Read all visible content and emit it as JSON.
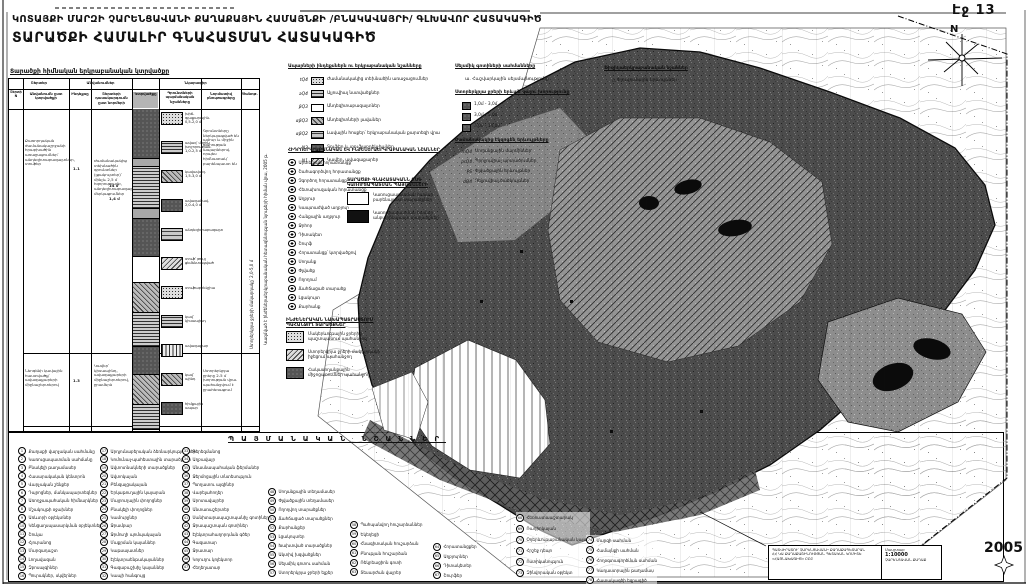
{
  "page": {
    "number_label": "Էջ 13",
    "year": "2005",
    "north_label": "N"
  },
  "titles": {
    "line1": "ԿՈՏԱՅՔԻ ՄԱՐԶԻ ՉԱՐԵՆՑԱՎԱՆԻ ՔԱՂԱՔԱՅԻՆ ՀԱՄԱՅՆՔԻ /ԲՆԱԿԱՎԱՅՐԻ/ ԳԼԽԱՎՈՐ ՀԱՏԱԿԱԳԻԾ",
    "line2": "ՏԱՐԱԾՔԻ ՀԱՄԱԼԻՐ ԳՆԱՀԱՏՄԱՆ ՀԱՏԱԿԱԳԻԾ"
  },
  "side_note": "Կազմված է ինժեներաերկրաբանական հետազննության նյութերի հիման վրա, 2005 թ.",
  "table": {
    "caption": "Տարածքի հիմնական երկրաբանական կտրվածքը",
    "groups": [
      "Շերտեր",
      "Անվանումներ",
      "Նկարագիր"
    ],
    "cols": [
      "Շերտի N",
      "Անվանումն ըստ կտրվածքի",
      "Ինդեքսը",
      "Շերտերի դասակարգումն ըստ նորմերի",
      "Կտրվածքը",
      "Գրունտների պայմանական նշանները",
      "Նորմատիվ բնութագրերը",
      "Ծանոթ."
    ],
    "idx1": "1.1",
    "idx2": "1.3",
    "thick1": "14 մ",
    "thick2": "1,4 մ",
    "row1_name": "Քառորդական ժամանակաշրջանի հրաբխածին առաջացումներ՝ անդեզիտաբազալտներ, տուֆեր",
    "row1_desc": "Ժամանակակից տեխնածին գրունտներ (լցակույտեր)՝ մինչև 2,5 մ հզորությամբ, անդեզիտաբազալտների մերկացումներ",
    "row1_note": "Գրունտները ներկայացված են ամուր և միջին ամրության ապարներով. որպես հիմնատակ՝ բարենպաստ են",
    "row2_name": "Նեոգենի կավային հաստվածք՝ ավազաքարերի միջնաշերտերով",
    "row2_desc": "Կավեր՝ կիսապինդ, ավազաքարերի միջնաշերտերով, ջրամերձ",
    "row2_note": "Ստորերկրյա ջրերը 2-5 մ խորության վրա. պահանջվում է ջրահեռացում",
    "note_rot": "Ստորերկրյա ջրերի մակարդակը՝ 2,0-5,0 մ",
    "strat": [
      {
        "cls": "sw-darknoise",
        "style": "height:50px"
      },
      {
        "cls": "sw-gray",
        "style": "height:8px"
      },
      {
        "cls": "sw-dash",
        "style": "height:42px"
      },
      {
        "cls": "sw-gray",
        "style": "height:10px"
      },
      {
        "cls": "sw-darknoise",
        "style": "height:38px"
      },
      {
        "cls": "sw-white",
        "style": "height:26px"
      },
      {
        "cls": "sw-diag",
        "style": "height:30px"
      },
      {
        "cls": "sw-dash",
        "style": "height:34px"
      },
      {
        "cls": "sw-darknoise",
        "style": "height:28px"
      },
      {
        "cls": "sw-diag",
        "style": "height:30px"
      },
      {
        "cls": "sw-dash",
        "style": "height:25px"
      }
    ],
    "thumbs": [
      {
        "cls": "sw-dots",
        "cap": "խիճ-գլաքարային. 0,5-2,0 մ"
      },
      {
        "cls": "sw-dash",
        "cap": "ավազ՝ միջին խոշորության. 1,0-2,5 մ"
      },
      {
        "cls": "sw-diag",
        "cap": "կավավազ. 1,5-3,0 մ"
      },
      {
        "cls": "sw-darknoise",
        "cap": "ավազակավ. 2,0-4,0 մ"
      },
      {
        "cls": "sw-brick",
        "cap": "անդեզիտաբազալտ"
      },
      {
        "cls": "sw-diag2",
        "cap": "տուֆ՝ թույլ ցեմենտացված"
      },
      {
        "cls": "sw-dots",
        "cap": "տուֆաբրեկչիա"
      },
      {
        "cls": "sw-dash",
        "cap": "կավ՝ կիսապինդ"
      },
      {
        "cls": "sw-vlines",
        "cap": "ավազաքար"
      },
      {
        "cls": "sw-diag",
        "cap": "կավ՝ պինդ"
      },
      {
        "cls": "sw-darknoise",
        "cap": "հիմքային ապար"
      }
    ]
  },
  "geo": {
    "h": "Ապարների ինդեքսներն ու երկրաբանական նշանները",
    "items": [
      {
        "ix": "tQ4",
        "cls": "sw-dots",
        "label": "Ժամանակակից տեխնածին առաջացումներ"
      },
      {
        "ix": "aQ4",
        "cls": "sw-dash",
        "label": "Ալյուվիալ նստվածքներ"
      },
      {
        "ix": "βQ3",
        "cls": "sw-white",
        "label": "Անդեզիտաբազալտներ"
      },
      {
        "ix": "αβQ3",
        "cls": "sw-diag",
        "label": "Անդեզիտների լավաներ"
      },
      {
        "ix": "αβQ2",
        "cls": "sw-brick",
        "label": "Լավային հոսքեր՝ երկրաբանական քարտեզի վրա"
      },
      {
        "ix": "N2",
        "cls": "sw-darknoise",
        "label": "Տուֆեր և տուֆաբրեկչիաներ"
      },
      {
        "ix": "N1",
        "cls": "sw-diag2",
        "label": "Կավեր, ավազաքարեր"
      }
    ]
  },
  "seismic": {
    "h": "Սեյսմիկ գոտիների սահմանները",
    "item": "ա.  Հաշվարկային սեյսմայնությունը"
  },
  "gw": {
    "h": "Ստորերկրյա ջրերի երևան գալու խորությունը",
    "items": [
      {
        "cls": "sw-darknoise",
        "label": "1,0մ - 3,0մ"
      },
      {
        "cls": "sw-darknoise",
        "label": "3,0մ - 5,0մ"
      },
      {
        "cls": "sw-darknoise",
        "label": "5,0մ - 10,0մ"
      }
    ]
  },
  "exo": {
    "h": "Ժամանակակից էկզոգեն երևույթները",
    "items": [
      {
        "ix": "mQ4",
        "label": "Սողանքային մարմիններ"
      },
      {
        "ix": "prQ4",
        "label": "Պրոլյուվիալ արտածումներ"
      },
      {
        "ix": "PS",
        "label": "Փլվածքային երևույթներ"
      },
      {
        "ix": "dQ4",
        "label": "Դելյուվիալ ծածկույթներ"
      }
    ]
  },
  "phys": {
    "h": "Ֆիզիկաերկրաբանական նշաններ",
    "icon": "△",
    "item": "Փլուզումային երևույթներ"
  },
  "hydro": {
    "h": "ՀԻԴՐՈԵՐԿՐԱԲԱՆԱԿԱՆ ԵՎ ԻՆԺԵՆԵՐԱԵՐԿՐԱԲԱՆԱԿԱՆ ՆՇԱՆՆԵՐ",
    "items": [
      "Արտեզյան հորատանցք",
      "Շահագործվող հորատանցք",
      "Չգործող հորատանցք",
      "Հետախուզական հորատանցք",
      "Աղբյուր",
      "Կապտաժված աղբյուր",
      "Հանքային աղբյուր",
      "Ջրհոր",
      "Դիտակետ",
      "Շուրֆ",
      "Հորատանցք՝ կտրվածքով",
      "Սողանք",
      "Փլվածք",
      "Ողողում",
      "Ճահճացած տարածք",
      "Լցակույտ",
      "Քարհանք"
    ]
  },
  "assess": {
    "h1": "ՏԱՐԱԾՔԻ ԳՆԱՀԱՏԱԿԱՆՆ ԸՍՏ",
    "h2": "ԿԱՌՈՒՑԱՊԱՏՄԱՆ ՊԱՅՄԱՆՆԵՐԻ",
    "items": [
      {
        "cls": "sw-white",
        "l1": "Կառուցապատման համար",
        "l2": "բարենպաստ տարածքներ"
      },
      {
        "cls": "sw-black",
        "l1": "Կառուցապատման համար",
        "l2": "անբարենպաստ տարածքներ"
      }
    ]
  },
  "eng": {
    "h1": "ԻՆԺԵՆԵՐԱԿԱՆ ՆԱԽԱՊԱՏՐԱՍՏՈՒՄ",
    "h2": "ՊԱՀԱՆՋՈՂ ՏԱՐԱԾՔՆԵՐ",
    "items": [
      {
        "cls": "sw-dots",
        "l1": "Մակերևութային ջրերից",
        "l2": "պաշտպանում պահանջող"
      },
      {
        "cls": "sw-diag2",
        "l1": "Ստորերկրյա ջրերի մակարդակի",
        "l2": "իջեցում պահանջող"
      },
      {
        "cls": "sw-darknoise",
        "l1": "Հակասողանքային",
        "l2": "միջոցառումներ պահանջող"
      }
    ]
  },
  "cond": {
    "letters": "ՊԱՅՄԱՆԱԿԱՆ ՆՇԱՆՆԵՐ",
    "cols": [
      {
        "items": [
          {
            "n": "1",
            "label": "Քաղաքի վարչական սահմանը"
          },
          {
            "n": "2",
            "label": "Կառուցապատման սահմանը"
          },
          {
            "n": "3",
            "label": "Բնակելի թաղամասեր"
          },
          {
            "n": "4",
            "label": "Հասարակական կենտրոն"
          },
          {
            "n": "5",
            "label": "Վարչական շենքեր"
          },
          {
            "n": "6",
            "label": "Դպրոցներ, մանկապարտեզներ"
          },
          {
            "n": "7",
            "label": "Առողջապահական հիմնարկներ"
          },
          {
            "n": "8",
            "label": "Մշակույթի օջախներ"
          },
          {
            "n": "9",
            "label": "Առևտրի օբյեկտներ"
          },
          {
            "n": "10",
            "label": "Կենցաղսպասարկման օբյեկտներ"
          },
          {
            "n": "11",
            "label": "Շուկա"
          },
          {
            "n": "12",
            "label": "Հյուրանոց"
          },
          {
            "n": "13",
            "label": "Մարզադաշտ"
          },
          {
            "n": "14",
            "label": "Լողավազան"
          },
          {
            "n": "15",
            "label": "Զբոսայգիներ"
          },
          {
            "n": "16",
            "label": "Պուրակներ, սկվերներ"
          }
        ]
      },
      {
        "items": [
          {
            "n": "17",
            "label": "Արդյունաբերական ձեռնարկություններ"
          },
          {
            "n": "18",
            "label": "Կոմունալ-պահեստային տարածքներ"
          },
          {
            "n": "19",
            "label": "Ավտոտնակների տարածքներ"
          },
          {
            "n": "20",
            "label": "Ավտոկայան"
          },
          {
            "n": "21",
            "label": "Բենզալցակայան"
          },
          {
            "n": "22",
            "label": "Երկաթուղային կայարան"
          },
          {
            "n": "23",
            "label": "Մայրուղային փողոցներ"
          },
          {
            "n": "24",
            "label": "Բնակելի փողոցներ"
          },
          {
            "n": "25",
            "label": "Կամուրջներ"
          },
          {
            "n": "26",
            "label": "Ջրամբար"
          },
          {
            "n": "27",
            "label": "Ջրմուղի պոմպակայան"
          },
          {
            "n": "28",
            "label": "Մաքրման կայաններ"
          },
          {
            "n": "29",
            "label": "Կաթսայատներ"
          },
          {
            "n": "30",
            "label": "Էլեկտրաենթակայաններ"
          },
          {
            "n": "31",
            "label": "Գազաբաշխիչ կայաններ"
          },
          {
            "n": "32",
            "label": "Կապի հանգույց"
          }
        ]
      },
      {
        "items": [
          {
            "n": "33",
            "label": "Գերեզմանոց"
          },
          {
            "n": "34",
            "label": "Աղբավայր"
          },
          {
            "n": "35",
            "label": "Անասնապահական ֆերմաներ"
          },
          {
            "n": "36",
            "label": "Ջերմոցային տնտեսություն"
          },
          {
            "n": "37",
            "label": "Պտղատու այգիներ"
          },
          {
            "n": "38",
            "label": "Վարելահողեր"
          },
          {
            "n": "39",
            "label": "Արոտավայրեր"
          },
          {
            "n": "40",
            "label": "Անտառաշերտեր"
          },
          {
            "n": "41",
            "label": "Սանիտարապաշտպանիչ գոտիներ"
          },
          {
            "n": "42",
            "label": "Ջրապաշտպան գոտիներ"
          },
          {
            "n": "43",
            "label": "Էլեկտրահաղորդման գծեր"
          },
          {
            "n": "44",
            "label": "Գազատար"
          },
          {
            "n": "45",
            "label": "Ջրատար"
          },
          {
            "n": "46",
            "label": "Կոյուղու կոլեկտոր"
          },
          {
            "n": "47",
            "label": "Հեղեղատար"
          }
        ]
      },
      {
        "items": [
          {
            "n": "48",
            "label": "Սողանքային տեղամասեր"
          },
          {
            "n": "49",
            "label": "Փլվածքային տեղամասեր"
          },
          {
            "n": "50",
            "label": "Ողողվող տարածքներ"
          },
          {
            "n": "51",
            "label": "Ճահճացած տարածքներ"
          },
          {
            "n": "52",
            "label": "Քարհանքեր"
          },
          {
            "n": "53",
            "label": "Լցակույտեր"
          },
          {
            "n": "54",
            "label": "Խախտված տարածքներ"
          },
          {
            "n": "55",
            "label": "Ակտիվ խզվածքներ"
          },
          {
            "n": "56",
            "label": "Սեյսմիկ գոտու սահման"
          },
          {
            "n": "57",
            "label": "Ստորերկրյա ջրերի ելքեր"
          }
        ]
      },
      {
        "items": [
          {
            "n": "58",
            "label": "Պահպանվող հուշարձաններ"
          },
          {
            "n": "59",
            "label": "Եկեղեցի"
          },
          {
            "n": "60",
            "label": "Հնագիտական հուշարձան"
          },
          {
            "n": "61",
            "label": "Բնության հուշարձան"
          },
          {
            "n": "62",
            "label": "Ռեկրեացիոն գոտի"
          },
          {
            "n": "63",
            "label": "Տեսարժան վայրեր"
          }
        ]
      },
      {
        "items": [
          {
            "n": "64",
            "label": "Հորատանցքեր"
          },
          {
            "n": "65",
            "label": "Աղբյուրներ"
          },
          {
            "n": "66",
            "label": "Դիտակետեր"
          },
          {
            "n": "67",
            "label": "Շուրֆեր"
          }
        ]
      },
      {
        "items": [
          {
            "n": "68",
            "label": "Հեռուստաաշտարակ"
          },
          {
            "n": "69",
            "label": "Ռադիոկայան"
          },
          {
            "n": "70",
            "label": "Օդերևութաբանական կայան"
          },
          {
            "n": "71",
            "label": "Հրշեջ դեպո"
          },
          {
            "n": "72",
            "label": "Ոստիկանություն"
          },
          {
            "n": "73",
            "label": "Զինվորական օբյեկտ"
          }
        ]
      },
      {
        "items": [
          {
            "n": "74",
            "label": "Մարզի սահման"
          },
          {
            "n": "75",
            "label": "Համայնքի սահման"
          },
          {
            "n": "76",
            "label": "Հողօգտագործման սահման"
          },
          {
            "n": "77",
            "label": "Կադաստրային թաղամաս"
          },
          {
            "n": "78",
            "label": "Հատակագծի եզրագիծ"
          }
        ]
      }
    ]
  },
  "tblock": {
    "left": [
      "ՊԱՏՎԻՐԱՏՈՒ՝ ՉԱՐԵՆՑԱՎԱՆԻ ՔԱՂԱՔԱՊԵՏԱՐԱՆ",
      "ՀՀ ԿԱ ՔԱՂԱՔԱՇԻՆՈՒԹՅԱՆ ՊԵՏԱԿԱՆ ԿՈՄԻՏԵ",
      "«ՀԱՅՆԱԽԱԳԻԾ» ԲԲԸ"
    ],
    "right": [
      "Մասշտաբ",
      "1:10000",
      "ՉԱՐԵՆՑԱՎԱՆ ՔԱՂԱՔ"
    ]
  }
}
